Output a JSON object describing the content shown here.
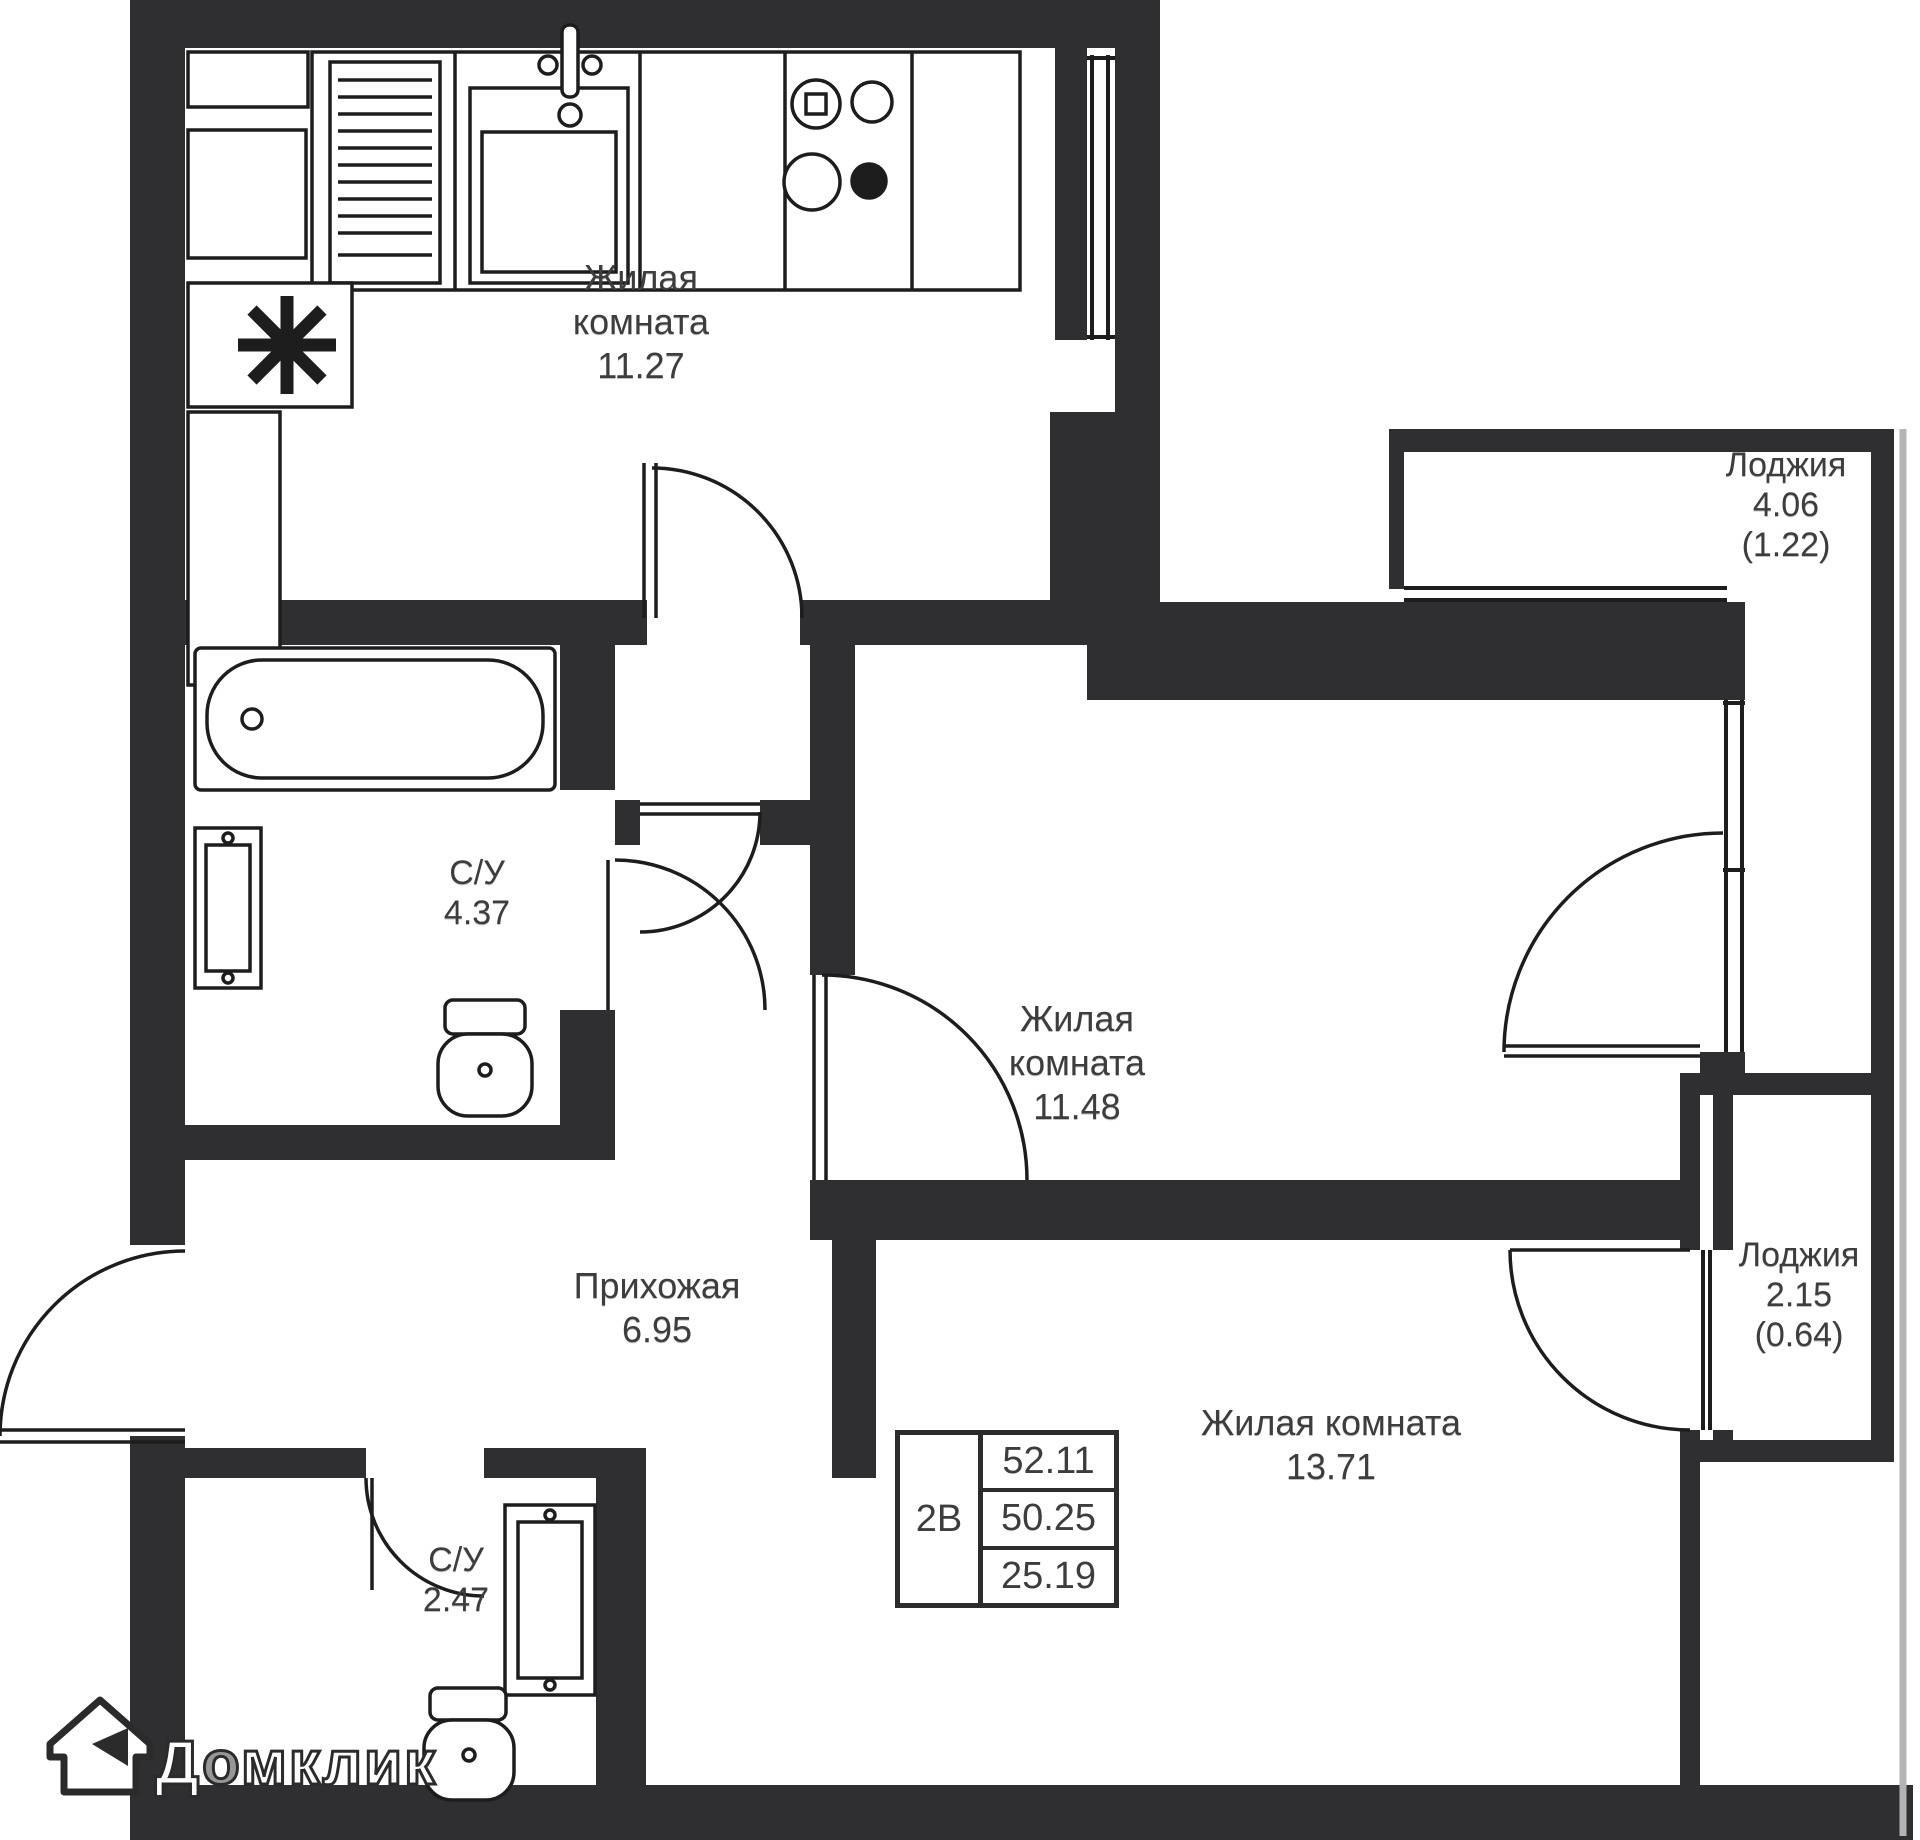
{
  "labels": {
    "room1127": {
      "l1": "Жилая",
      "l2": "комната",
      "area": "11.27"
    },
    "loggia406": {
      "l1": "Лоджия",
      "area": "4.06",
      "reduced": "(1.22)"
    },
    "su437": {
      "l1": "С/У",
      "area": "4.37"
    },
    "room1148": {
      "l1": "Жилая",
      "l2": "комната",
      "area": "11.48"
    },
    "hallway": {
      "l1": "Прихожая",
      "area": "6.95"
    },
    "loggia215": {
      "l1": "Лоджия",
      "area": "2.15",
      "reduced": "(0.64)"
    },
    "room1371": {
      "l1": "Жилая комната",
      "area": "13.71"
    },
    "su247": {
      "l1": "С/У",
      "area": "2.47"
    }
  },
  "stamp": {
    "unit_type": "2В",
    "total_area": "52.11",
    "area": "50.25",
    "living_area": "25.19"
  },
  "watermark": {
    "brand_part1": "Д",
    "brand_part2": "о",
    "brand_part3": "мклик"
  },
  "colors": {
    "wall": "#2f2f31",
    "outline": "#1d1d1d",
    "background": "#ffffff",
    "label_text": "#3d3d3d",
    "loggia_guide_gray": "#b4b4b4"
  }
}
